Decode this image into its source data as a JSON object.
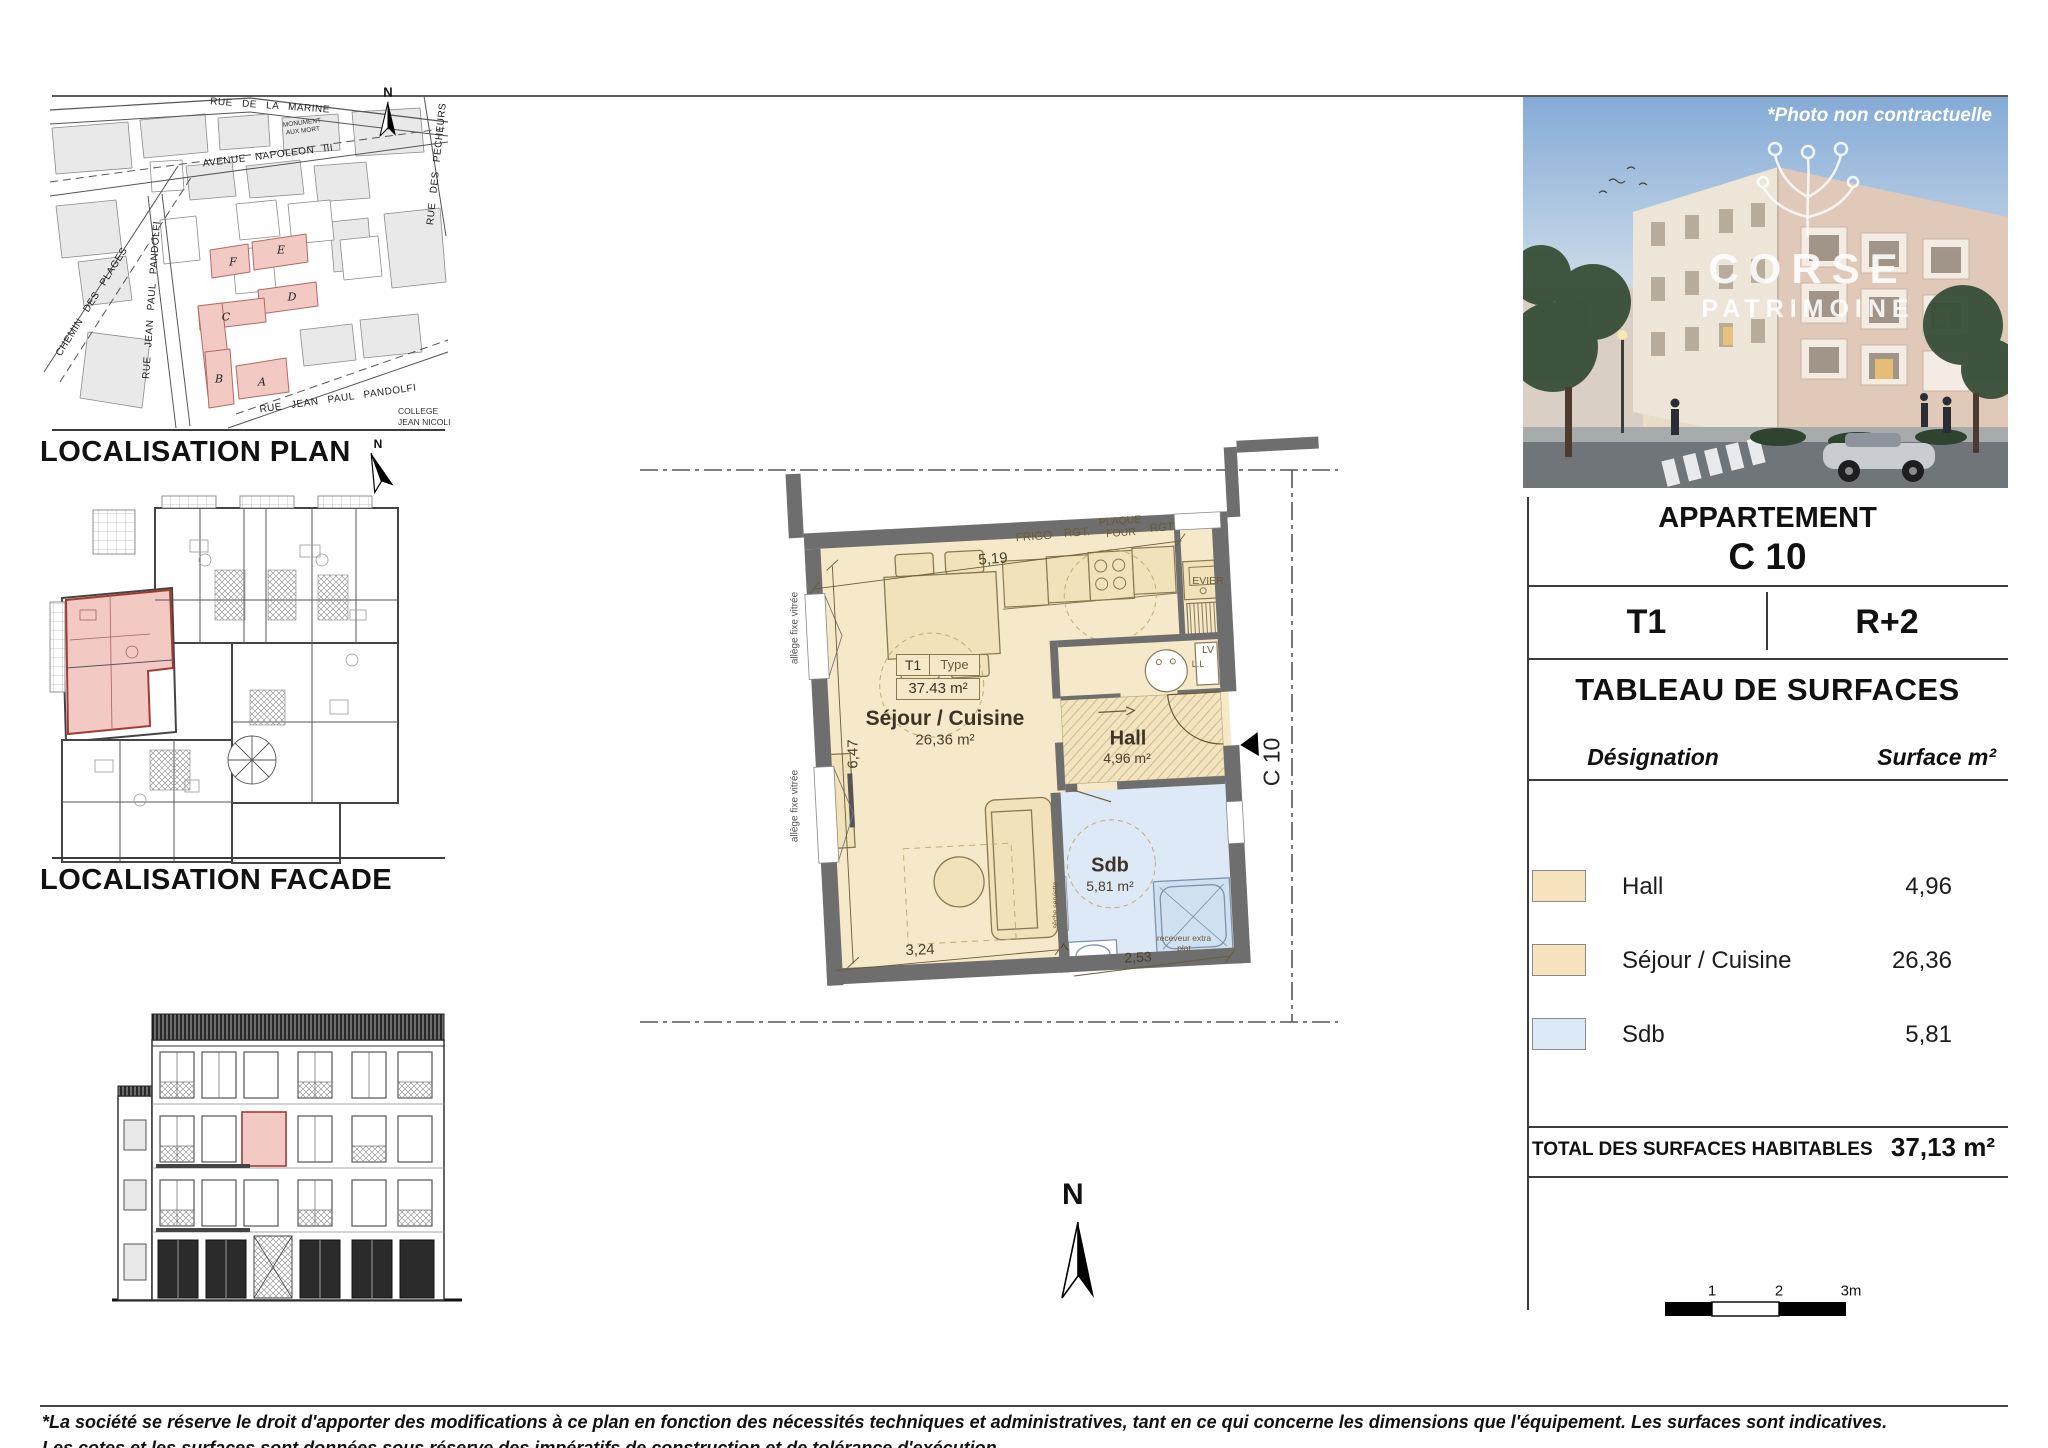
{
  "headings": {
    "localisation_plan": "LOCALISATION PLAN",
    "localisation_facade": "LOCALISATION FACADE"
  },
  "map": {
    "streets": {
      "marine": "RUE DE LA MARINE",
      "napoleon": "AVENUE  NAPOLEON  III",
      "plages": "CHEMIN  DES  PLAGES",
      "pandolfi_vertical": "RUE  JEAN  PAUL  PANDOLFI",
      "pecheurs": "RUE  DES  PECHEURS",
      "pandolfi_diagonal": "RUE   JEAN   PAUL   PANDOLFI"
    },
    "monument_line1": "MONUMENT",
    "monument_line2": "AUX MORT",
    "college_line1": "COLLEGE",
    "college_line2": "JEAN NICOLI",
    "buildings": [
      "F",
      "E",
      "D",
      "C",
      "B",
      "A"
    ],
    "north": "N"
  },
  "apartment_plan": {
    "type_cell": "T1",
    "type_label": "Type",
    "total_area_box": "37.43 m²",
    "sejour_name": "Séjour / Cuisine",
    "sejour_area": "26,36 m²",
    "hall_name": "Hall",
    "hall_area": "4,96 m²",
    "sdb_name": "Sdb",
    "sdb_area": "5,81 m²",
    "kitchen": {
      "frigo": "FRIGO",
      "rgt1": "RGT.",
      "plaque": "PLAQUE",
      "four": "FOUR",
      "rgt2": "RGT.",
      "evier": "EVIER",
      "lv": "LV",
      "ll": "L.L"
    },
    "dims": {
      "top": "5,19",
      "left": "6,47",
      "bottom": "3,24",
      "sdb": "2,53",
      "small": "7"
    },
    "allege": "allège fixe vitrée",
    "seche_serviette": "sèche serviette",
    "receveur_line1": "receveur extra",
    "receveur_line2": "plat",
    "unit_marker": "C 10",
    "north": "N"
  },
  "panel": {
    "photo_note": "*Photo non contractuelle",
    "brand_line1": "CORSE",
    "brand_line2": "PATRIMOINE",
    "title": "APPARTEMENT",
    "unit": "C 10",
    "typology": "T1",
    "floor": "R+2",
    "table_title": "TABLEAU DE SURFACES",
    "col_designation": "Désignation",
    "col_surface": "Surface m²",
    "rows": [
      {
        "label": "Hall",
        "surface": "4,96",
        "color": "#f7e4bf"
      },
      {
        "label": "Séjour / Cuisine",
        "surface": "26,36",
        "color": "#f7e4bf"
      },
      {
        "label": "Sdb",
        "surface": "5,81",
        "color": "#dce9f8"
      }
    ],
    "total_label": "TOTAL DES SURFACES HABITABLES",
    "total_value": "37,13 m²"
  },
  "scalebar": {
    "tick1": "1",
    "tick2": "2",
    "tick3": "3m"
  },
  "footer": {
    "line1": "*La société se réserve le droit d'apporter des modifications à ce plan en fonction des nécessités techniques et administratives, tant en ce qui concerne les dimensions que l'équipement. Les surfaces sont indicatives.",
    "line2": "Les cotes et les surfaces sont données sous réserve des impératifs de construction et de tolérance d'exécution."
  },
  "colors": {
    "room_beige": "#f6e9c9",
    "room_blue": "#dde9f6",
    "highlight_pink": "#f3c9c4",
    "wall_gray": "#6e6e6e"
  }
}
